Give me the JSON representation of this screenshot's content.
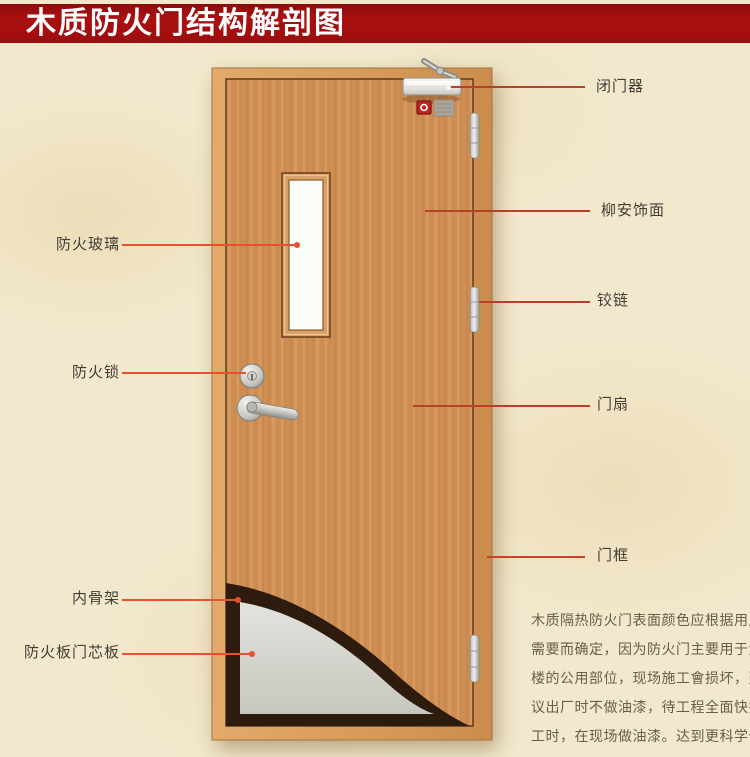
{
  "title": "木质防火门结构解剖图",
  "labels": {
    "door_closer": "闭门器",
    "veneer": "柳安饰面",
    "hinge": "铰链",
    "door_leaf": "门扇",
    "door_frame": "门框",
    "fire_glass": "防火玻璃",
    "fire_lock": "防火锁",
    "inner_skeleton": "内骨架",
    "core_board": "防火板门芯板"
  },
  "description": {
    "lines": [
      "木质隔热防火门表面颜色应根据用户",
      "需要而确定，因为防火门主要用于大",
      "楼的公用部位，现场施工會损坏，建",
      "议出厂时不做油漆，待工程全面快完",
      "工时，在现场做油漆。达到更科学化",
      "更人性化的服务。"
    ]
  },
  "colors": {
    "banner_red": "#a30d0d",
    "callout_left": "#e8512d",
    "callout_right": "#b8402a",
    "background": "#f2e8cd",
    "door_wood": "#cf8e53"
  }
}
